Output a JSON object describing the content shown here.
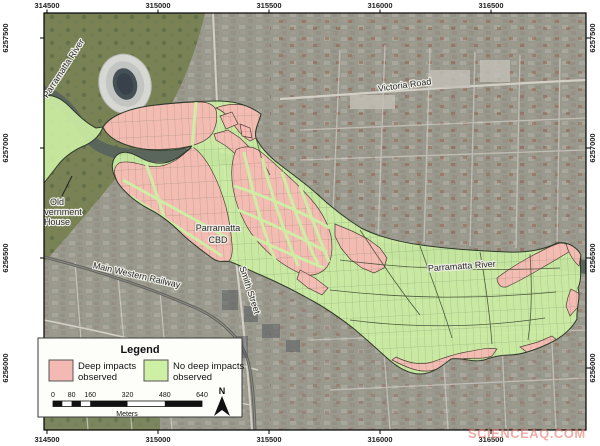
{
  "axis": {
    "top": [
      "314500",
      "315000",
      "315500",
      "316000",
      "316500"
    ],
    "bottom": [
      "314500",
      "315000",
      "315500",
      "316000",
      "316500"
    ],
    "left": [
      "6257500",
      "6257000",
      "6256500",
      "6256000"
    ],
    "right": [
      "6257500",
      "6257000",
      "6256500",
      "6256000"
    ]
  },
  "map_labels": {
    "river_nw": "Parramatta River",
    "victoria_road": "Victoria Road",
    "ogh_line1": "Old",
    "ogh_line2": "Government",
    "ogh_line3": "House",
    "cbd_line1": "Parramatta",
    "cbd_line2": "CBD",
    "railway": "Main Western Railway",
    "smith_street": "Smith Street",
    "river_east": "Parramatta River"
  },
  "legend": {
    "title": "Legend",
    "items": [
      {
        "line1": "Deep impacts",
        "line2": "observed",
        "color": "#f5b9b3"
      },
      {
        "line1": "No deep impacts",
        "line2": "observed",
        "color": "#cdf0a5"
      }
    ],
    "scale_ticks": [
      "0",
      "80",
      "160",
      "320",
      "480",
      "640"
    ],
    "scale_unit": "Meters",
    "north": "N"
  },
  "watermark": {
    "text": "SCIENCEAQ.COM",
    "color": "rgba(233,125,115,0.65)"
  },
  "colors": {
    "deep_impact": "#f5b9b3",
    "no_deep_impact": "#cdf0a5",
    "impact_outline": "#2e3a2a",
    "river": "#5a655c",
    "park": "#788254",
    "urban": "#9a998e"
  }
}
